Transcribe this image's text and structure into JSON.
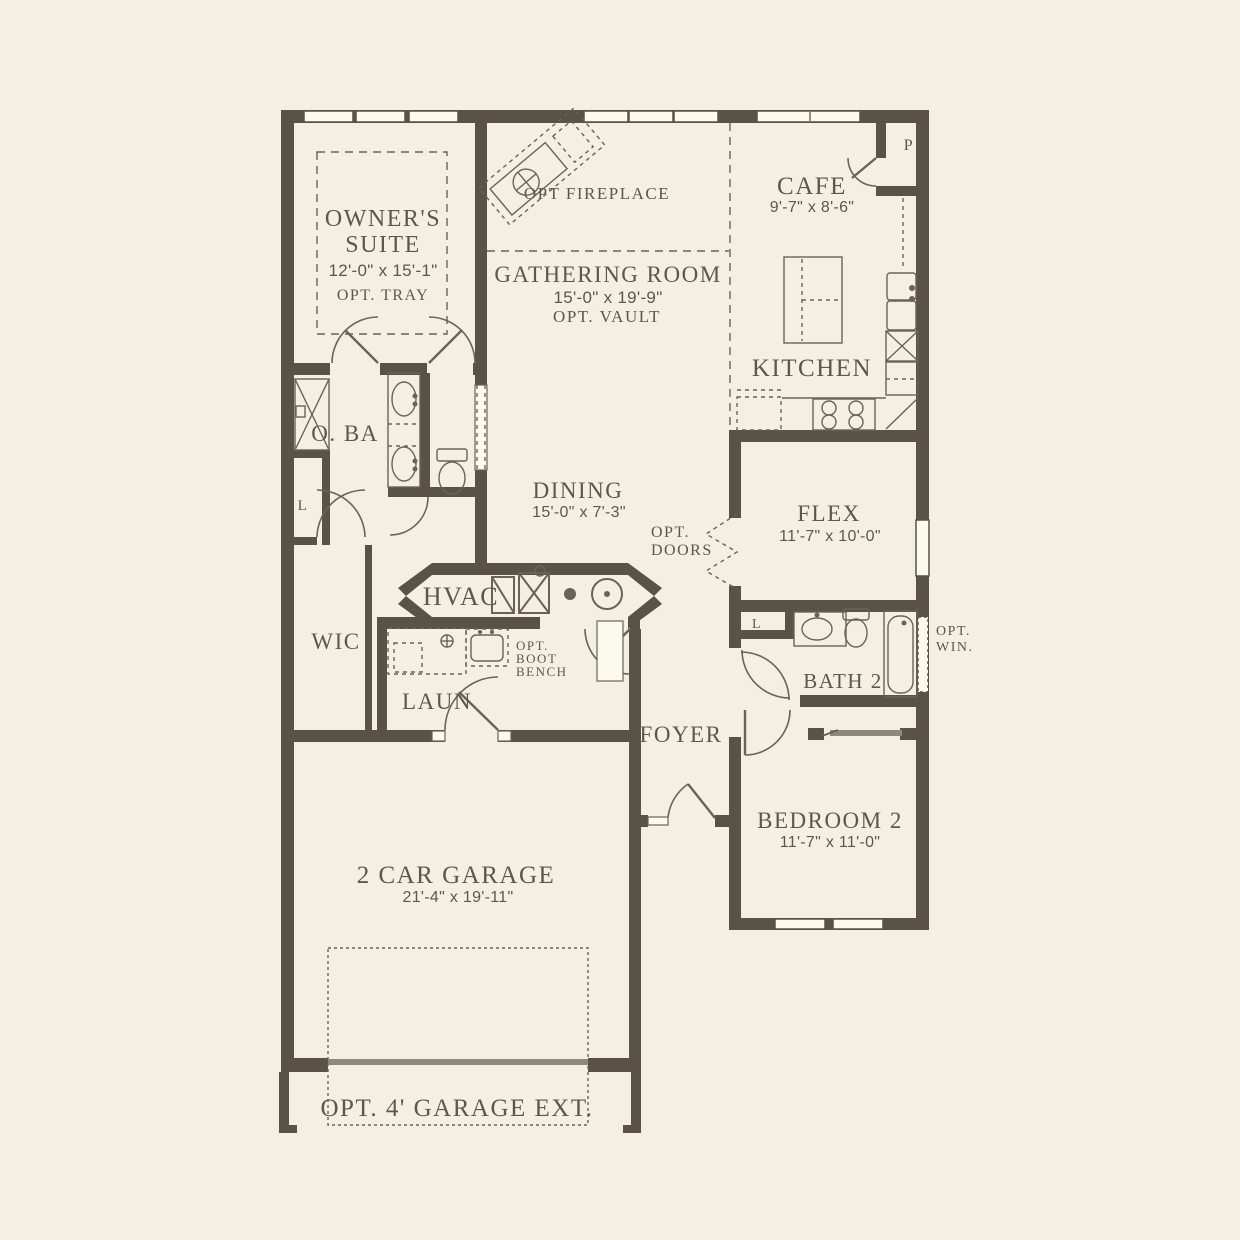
{
  "palette": {
    "background": "#f4f0e1",
    "wall": "#5a5244",
    "ink": "#5d574a",
    "line": "#6a6355",
    "paper": "#fcf9ee",
    "accent_gray": "#8f8878"
  },
  "plan": {
    "owners_suite": {
      "name_line1": "OWNER'S",
      "name_line2": "SUITE",
      "dims": "12'-0\" x 15'-1\"",
      "option": "OPT. TRAY"
    },
    "opt_fireplace_label": "OPT FIREPLACE",
    "gathering_room": {
      "name": "GATHERING ROOM",
      "dims": "15'-0\" x 19'-9\"",
      "option": "OPT. VAULT"
    },
    "cafe": {
      "name": "CAFE",
      "dims": "9'-7\" x 8'-6\""
    },
    "pantry_label": "P",
    "kitchen": {
      "name": "KITCHEN"
    },
    "owners_bath": {
      "name": "O. BA",
      "linen_label": "L"
    },
    "dining": {
      "name": "DINING",
      "dims": "15'-0\" x 7'-3\""
    },
    "opt_doors": {
      "line1": "OPT.",
      "line2": "DOORS"
    },
    "flex": {
      "name": "FLEX",
      "dims": "11'-7\" x 10'-0\""
    },
    "hvac_label": "HVAC",
    "wic": {
      "name": "WIC"
    },
    "boot_bench": {
      "line1": "OPT.",
      "line2": "BOOT",
      "line3": "BENCH"
    },
    "laundry": {
      "name": "LAUN"
    },
    "bath2": {
      "name": "BATH 2",
      "linen_label": "L"
    },
    "opt_win": {
      "line1": "OPT.",
      "line2": "WIN."
    },
    "foyer": {
      "name": "FOYER"
    },
    "bedroom2": {
      "name": "BEDROOM 2",
      "dims": "11'-7\" x 11'-0\""
    },
    "garage": {
      "name": "2 CAR GARAGE",
      "dims": "21'-4\" x 19'-11\""
    },
    "garage_ext_label": "OPT. 4' GARAGE EXT."
  }
}
